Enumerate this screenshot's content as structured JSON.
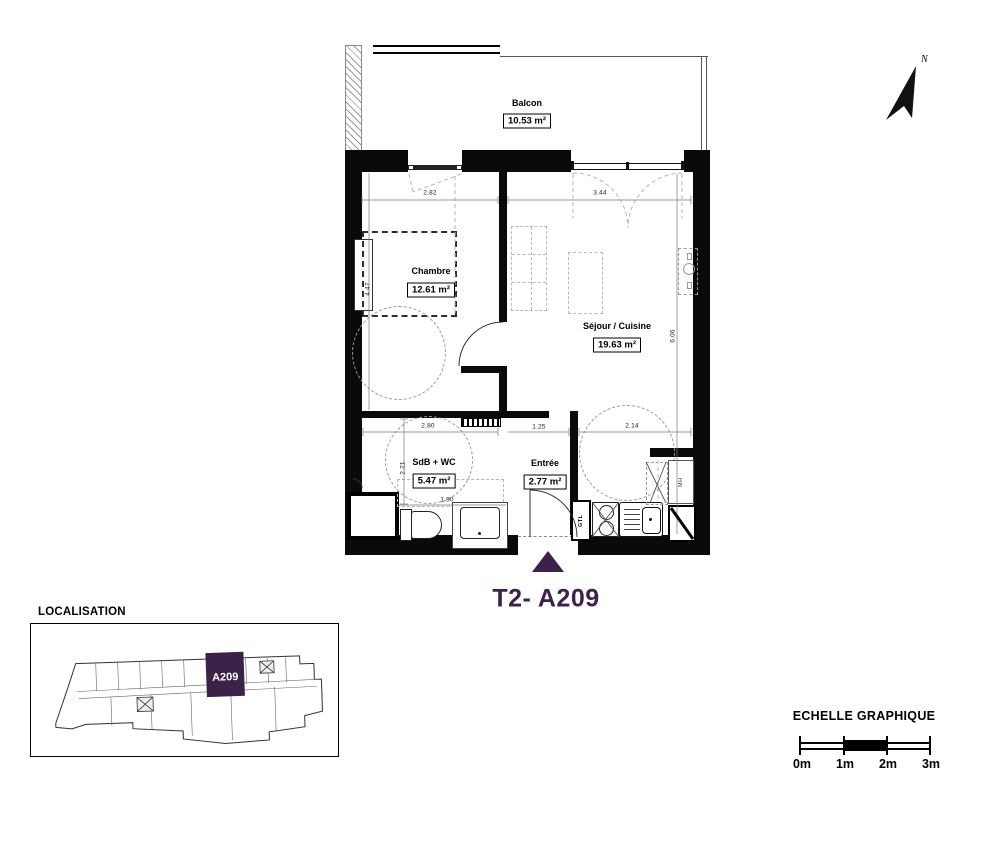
{
  "title": "T2- A209",
  "north": "N",
  "plan": {
    "rooms": [
      {
        "name": "Balcon",
        "area": "10.53 m²"
      },
      {
        "name": "Chambre",
        "area": "12.61 m²"
      },
      {
        "name": "Séjour / Cuisine",
        "area": "19.63 m²"
      },
      {
        "name": "SdB + WC",
        "area": "5.47 m²"
      },
      {
        "name": "Entrée",
        "area": "2.77 m²"
      }
    ],
    "dims": {
      "chambre_w": "2.82",
      "sejour_w": "3.44",
      "left_h": "4.47",
      "right_h": "6.06",
      "sdb_w": "2.80",
      "entree_w": "1.25",
      "cuisine_w": "2.14",
      "sdb_h": "2.21",
      "sdb_b": "1.90"
    },
    "labels": {
      "gtl": "GTL",
      "mh": "MH"
    }
  },
  "localisation": {
    "heading": "LOCALISATION",
    "unit": "A209"
  },
  "scale": {
    "heading": "ECHELLE GRAPHIQUE",
    "ticks": [
      "0m",
      "1m",
      "2m",
      "3m"
    ]
  },
  "colors": {
    "accent": "#3C2149",
    "wall": "#000000"
  }
}
